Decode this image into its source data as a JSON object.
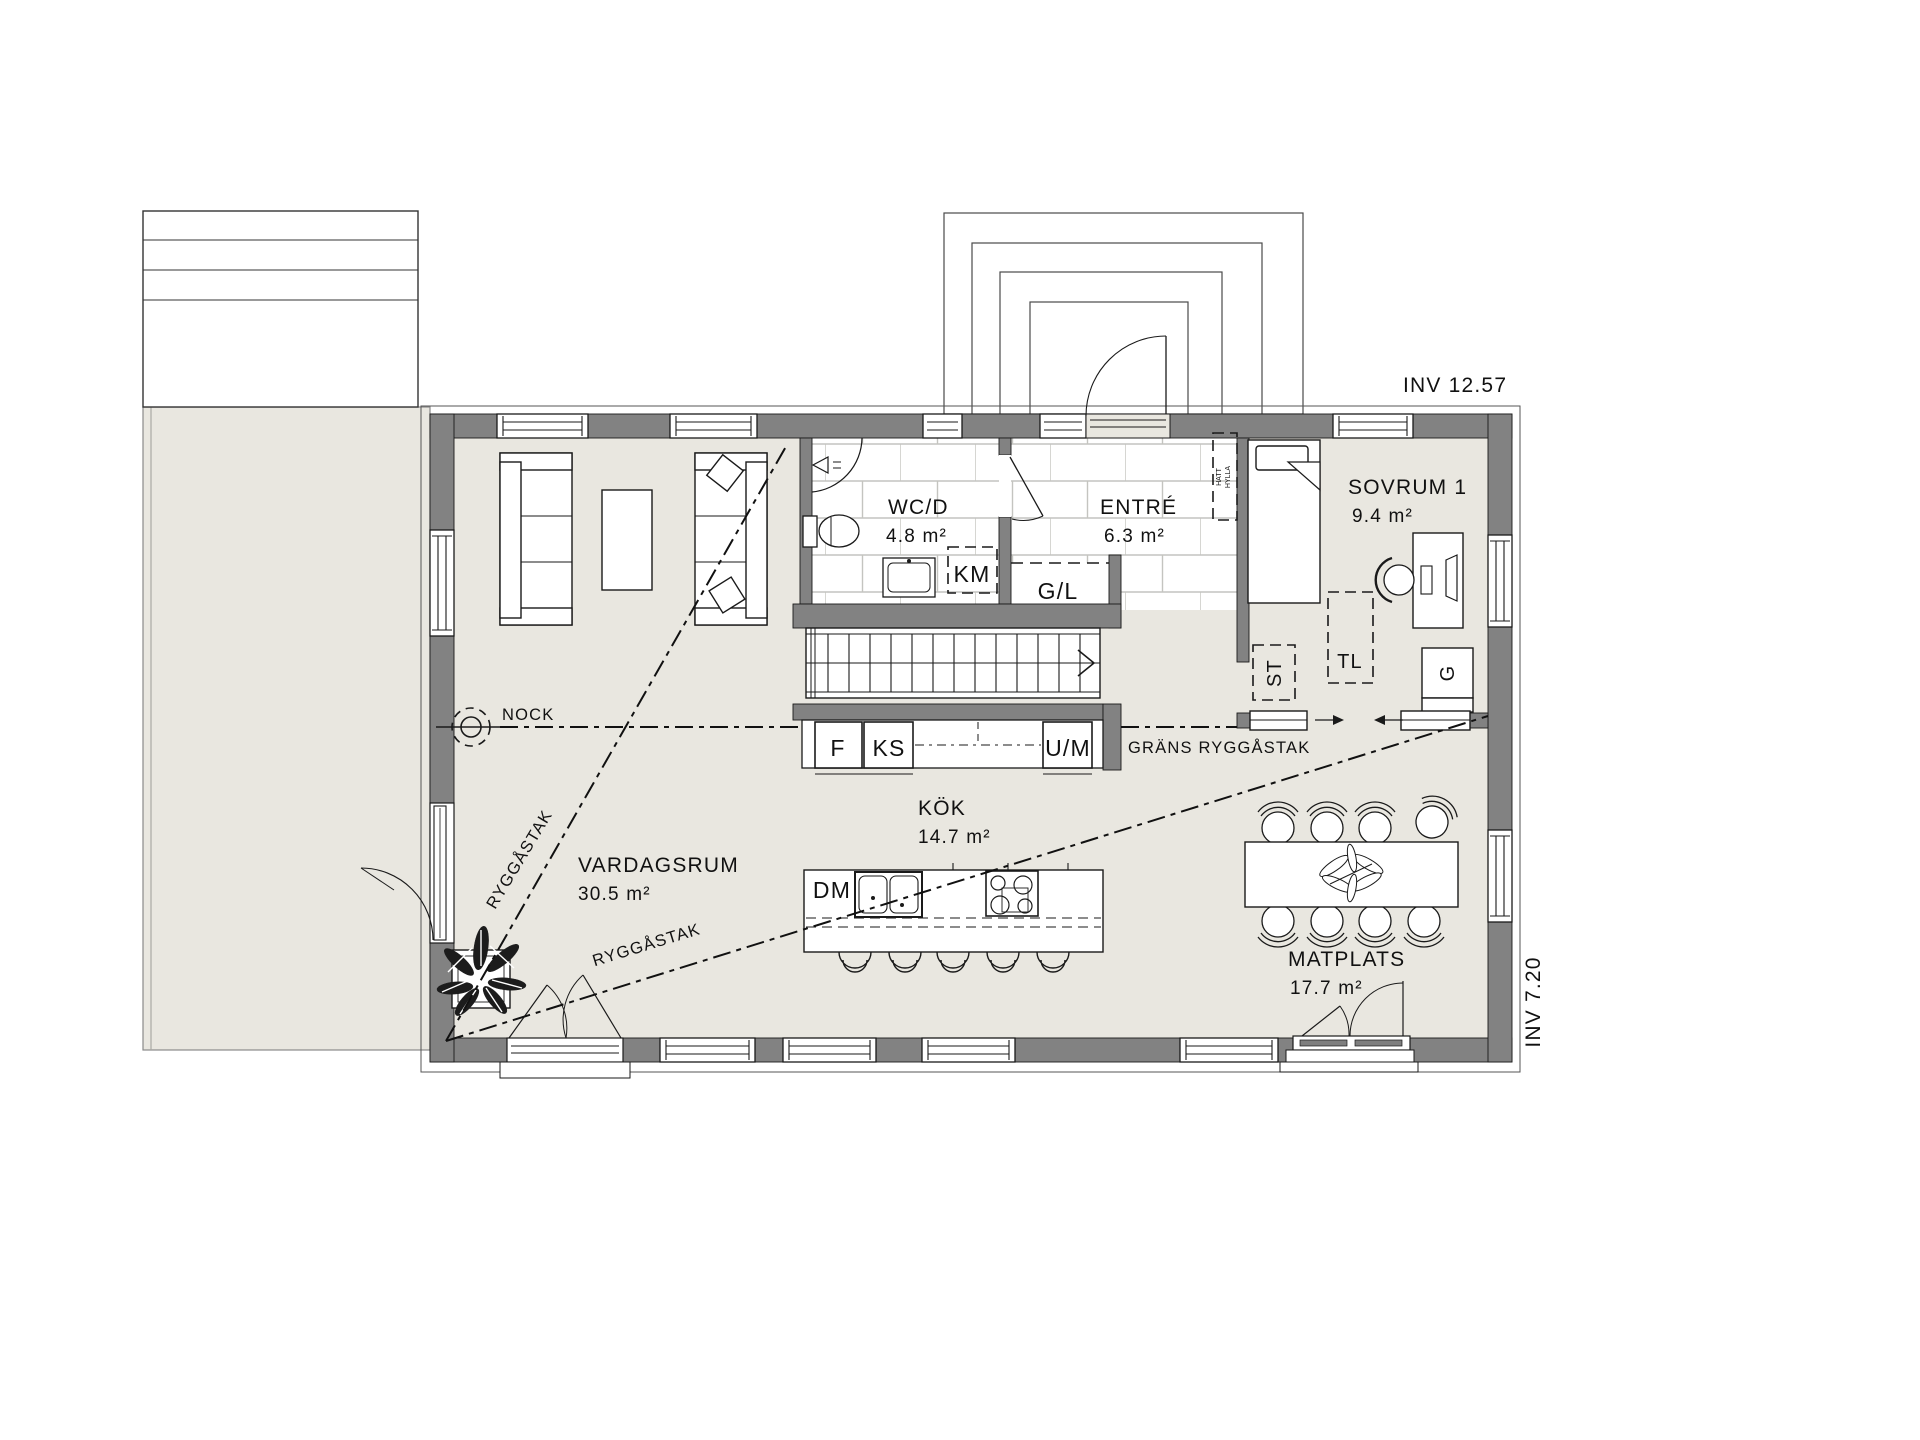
{
  "annotations": {
    "inv_top": "INV 12.57",
    "inv_right": "INV 7.20",
    "nock": "NOCK",
    "ryggastak_steep": "RYGGÅSTAK",
    "ryggastak_shallow": "RYGGÅSTAK",
    "grans_ryggastak": "GRÄNS RYGGÅSTAK"
  },
  "rooms": {
    "vardagsrum": {
      "name": "VARDAGSRUM",
      "area": "30.5 m²"
    },
    "kok": {
      "name": "KÖK",
      "area": "14.7 m²"
    },
    "wcd": {
      "name": "WC/D",
      "area": "4.8 m²"
    },
    "entre": {
      "name": "ENTRÉ",
      "area": "6.3 m²"
    },
    "sovrum1": {
      "name": "SOVRUM 1",
      "area": "9.4 m²"
    },
    "matplats": {
      "name": "MATPLATS",
      "area": "17.7 m²"
    }
  },
  "fixtures": {
    "f": "F",
    "ks": "KS",
    "um": "U/M",
    "km": "KM",
    "gl": "G/L",
    "dm": "DM",
    "st": "ST",
    "tl": "TL",
    "g": "G",
    "hat_shelf_1": "HATT",
    "hat_shelf_2": "HYLLA"
  },
  "colors": {
    "floor": "#e9e7e0",
    "wall": "#828282",
    "tile_grout": "#c4c4c0"
  }
}
